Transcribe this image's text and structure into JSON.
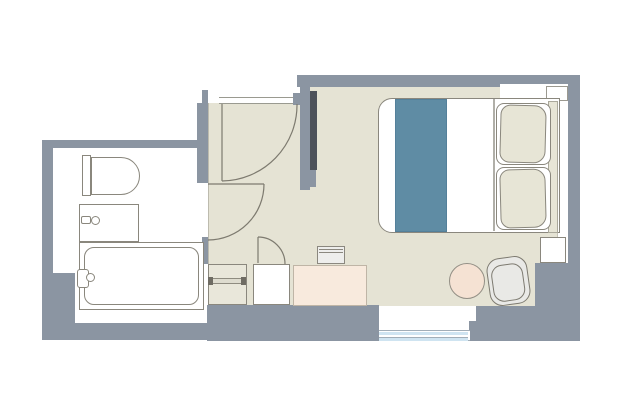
{
  "document": {
    "type": "floor-plan",
    "description": "Hotel guest room floor plan with bathroom, entry hall and bedroom"
  },
  "colors": {
    "wall": "#8b95a2",
    "floor": "#e5e3d4",
    "bathroom_floor": "#ffffff",
    "bed_runner": "#5f8ca4",
    "window_glass": "#cfe4f1",
    "desk": "#f8eadd",
    "stool": "#f5e2d3",
    "chair": "#e9e9e6",
    "pillow": "#e7e5d6",
    "tv": "#4d525a",
    "outline": "#8a877d"
  },
  "rooms": {
    "bathroom": {
      "fixtures": [
        "toilet",
        "vanity-sink",
        "bathtub"
      ]
    },
    "entry": {
      "elements": [
        "entry-door",
        "bathroom-door",
        "shelf-unit",
        "storage-cabinet"
      ]
    },
    "bedroom": {
      "furniture": [
        "wall-tv",
        "double-bed",
        "bed-runner",
        "pillows",
        "headboard",
        "nightstand",
        "desk",
        "desk-tv",
        "stool",
        "chair",
        "window"
      ]
    }
  }
}
